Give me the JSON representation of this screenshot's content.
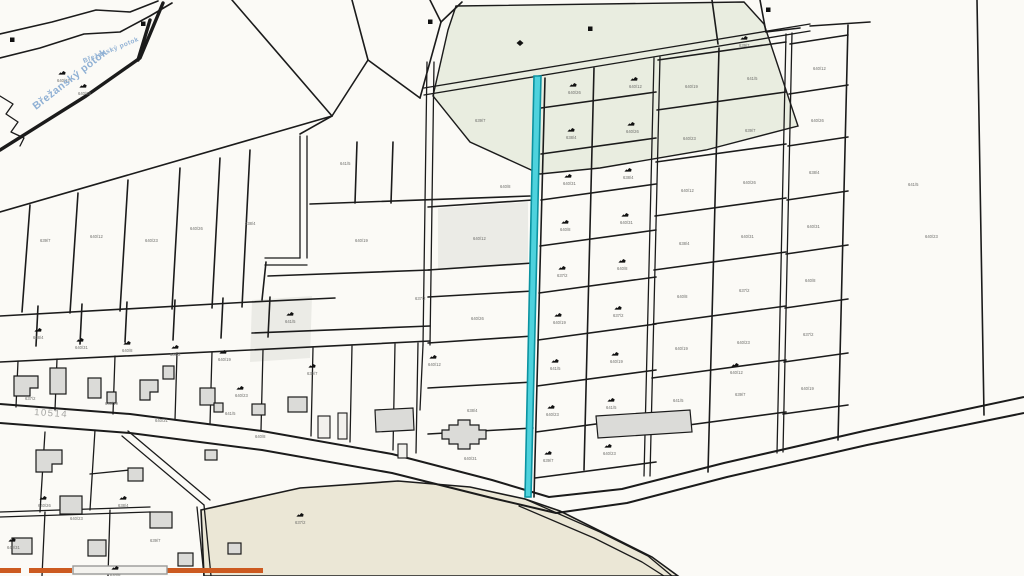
{
  "map": {
    "title": "cadastral-map-view",
    "colors": {
      "background": "#fbfaf6",
      "boundary": "#1b1b1b",
      "green_area": "#e9ede0",
      "olive_field": "#ebe7d6",
      "gray_parcel": "#ebebe6",
      "building": "#dbdbd8",
      "highlight_fill": "#4ed2dd",
      "highlight_stroke": "#0b93a1",
      "orange_road": "#cc5a20",
      "road_casing": "#9a9a98",
      "stream_label_color": "#8fb0d4",
      "road_label_color": "#a3a3a0"
    },
    "labels": {
      "stream_main": "Břežanský potok",
      "stream_small": "Břežanský potok",
      "road_number": "10514"
    },
    "parcel_number_samples": [
      "640/12",
      "640/26",
      "638/4",
      "640/31",
      "640/8",
      "637/2",
      "640/19",
      "641/5",
      "640/23",
      "639/7"
    ],
    "symbols": [
      [
        62,
        73,
        "b"
      ],
      [
        83,
        86,
        "b"
      ],
      [
        12,
        40,
        "s"
      ],
      [
        143,
        24,
        "s"
      ],
      [
        430,
        22,
        "s"
      ],
      [
        520,
        43,
        "d"
      ],
      [
        590,
        29,
        "s"
      ],
      [
        768,
        10,
        "s"
      ],
      [
        38,
        330,
        "b"
      ],
      [
        80,
        340,
        "b"
      ],
      [
        127,
        343,
        "b"
      ],
      [
        175,
        347,
        "b"
      ],
      [
        223,
        352,
        "b"
      ],
      [
        290,
        314,
        "b"
      ],
      [
        240,
        388,
        "b"
      ],
      [
        312,
        366,
        "b"
      ],
      [
        433,
        357,
        "b"
      ],
      [
        573,
        85,
        "b"
      ],
      [
        571,
        130,
        "b"
      ],
      [
        568,
        176,
        "b"
      ],
      [
        565,
        222,
        "b"
      ],
      [
        562,
        268,
        "b"
      ],
      [
        558,
        315,
        "b"
      ],
      [
        555,
        361,
        "b"
      ],
      [
        551,
        407,
        "b"
      ],
      [
        548,
        453,
        "b"
      ],
      [
        634,
        79,
        "b"
      ],
      [
        631,
        124,
        "b"
      ],
      [
        628,
        170,
        "b"
      ],
      [
        625,
        215,
        "b"
      ],
      [
        622,
        261,
        "b"
      ],
      [
        618,
        308,
        "b"
      ],
      [
        615,
        354,
        "b"
      ],
      [
        611,
        400,
        "b"
      ],
      [
        608,
        446,
        "b"
      ],
      [
        744,
        38,
        "b"
      ],
      [
        735,
        365,
        "b"
      ],
      [
        43,
        498,
        "b"
      ],
      [
        123,
        498,
        "b"
      ],
      [
        12,
        540,
        "b"
      ],
      [
        115,
        568,
        "b"
      ],
      [
        300,
        515,
        "b"
      ]
    ],
    "tiny_labels": [
      [
        690,
        88
      ],
      [
        752,
        80
      ],
      [
        688,
        140
      ],
      [
        750,
        132
      ],
      [
        686,
        192
      ],
      [
        748,
        184
      ],
      [
        684,
        245
      ],
      [
        746,
        238
      ],
      [
        682,
        298
      ],
      [
        744,
        292
      ],
      [
        680,
        350
      ],
      [
        678,
        402
      ],
      [
        742,
        344
      ],
      [
        740,
        396
      ],
      [
        818,
        70
      ],
      [
        816,
        122
      ],
      [
        814,
        174
      ],
      [
        812,
        228
      ],
      [
        810,
        282
      ],
      [
        808,
        336
      ],
      [
        806,
        390
      ],
      [
        913,
        186
      ],
      [
        930,
        238
      ],
      [
        480,
        122
      ],
      [
        478,
        240
      ],
      [
        476,
        320
      ],
      [
        472,
        412
      ],
      [
        469,
        460
      ],
      [
        505,
        188
      ],
      [
        420,
        300
      ],
      [
        360,
        242
      ],
      [
        345,
        165
      ],
      [
        150,
        242
      ],
      [
        45,
        242
      ],
      [
        95,
        238
      ],
      [
        195,
        230
      ],
      [
        250,
        225
      ],
      [
        160,
        422
      ],
      [
        260,
        438
      ],
      [
        30,
        400
      ],
      [
        110,
        405
      ],
      [
        230,
        415
      ],
      [
        75,
        520
      ],
      [
        155,
        542
      ]
    ]
  }
}
